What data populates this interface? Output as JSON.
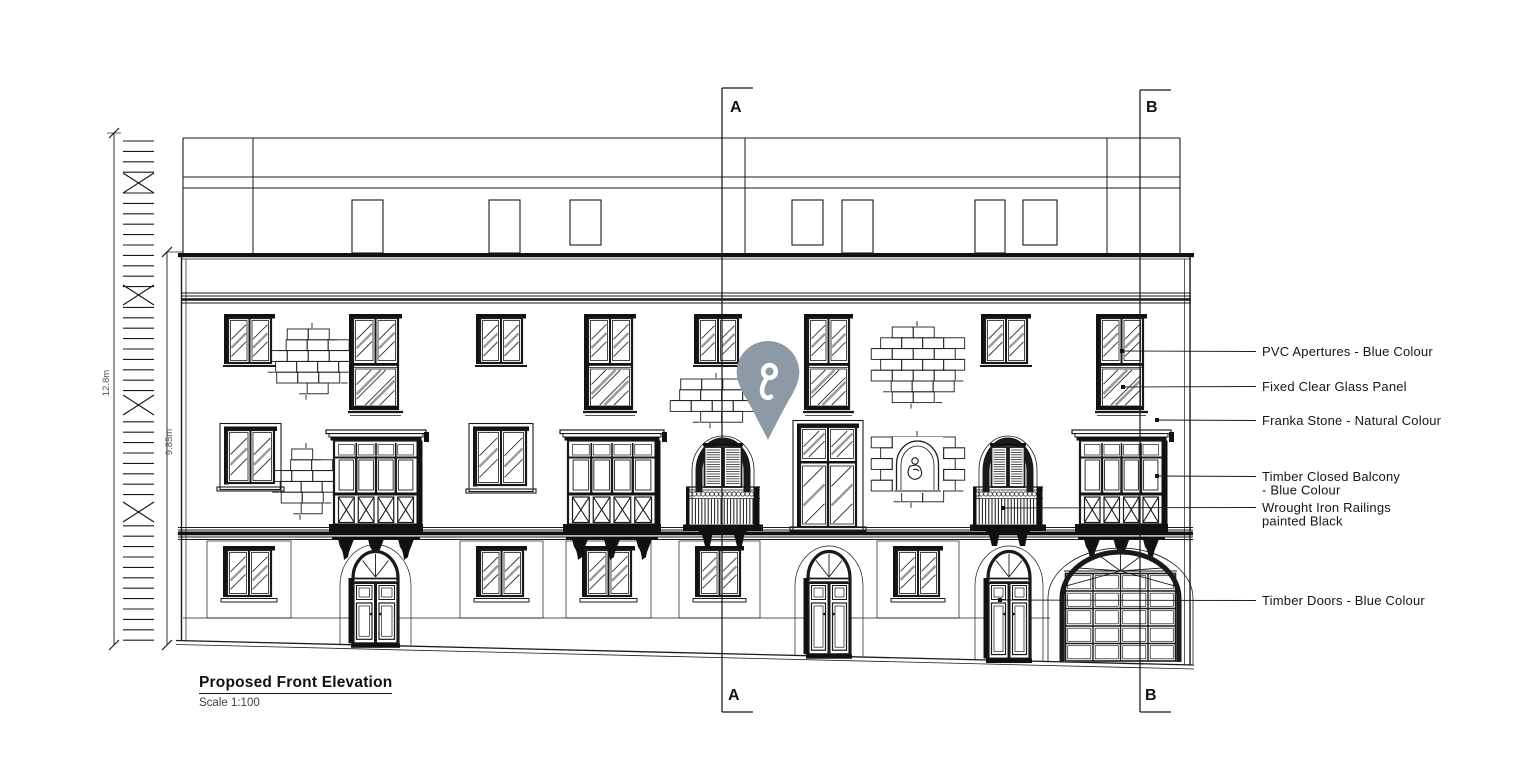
{
  "colors": {
    "ink": "#1a1a1a",
    "paper": "#ffffff",
    "hatch": "#303030",
    "reflection": "#9a9a9a",
    "pin": "#8c99a7"
  },
  "title_block": {
    "title": "Proposed Front Elevation",
    "scale": "Scale 1:100"
  },
  "dimensions": [
    {
      "label": "12.8m",
      "x": 114,
      "y1": 133,
      "y2": 645,
      "label_x": 109,
      "label_y": 383
    },
    {
      "label": "9.85m",
      "x": 167,
      "y1": 252,
      "y2": 645,
      "label_x": 172,
      "label_y": 442
    }
  ],
  "ruler": {
    "x1": 123,
    "x2": 154,
    "y_top": 141,
    "y_bottom": 641,
    "step": 10.4,
    "cross_marks_y": [
      183,
      295,
      405,
      512
    ]
  },
  "section_markers": [
    {
      "label": "A",
      "x": 722,
      "top": 88,
      "bottom": 712,
      "arm": 31,
      "tx_top": 730,
      "ty_top": 112,
      "tx_bot": 728,
      "ty_bot": 700
    },
    {
      "label": "B",
      "x": 1140,
      "top": 90,
      "bottom": 712,
      "arm": 31,
      "tx_top": 1146,
      "ty_top": 112,
      "tx_bot": 1145,
      "ty_bot": 700
    }
  ],
  "annotations": [
    {
      "id": "pvc-apertures",
      "lines": [
        "PVC Apertures - Blue Colour"
      ],
      "text_x": 1262,
      "text_y": 356,
      "anchor_x": 1122,
      "anchor_y": 351
    },
    {
      "id": "glass-panel",
      "lines": [
        "Fixed Clear Glass Panel"
      ],
      "text_x": 1262,
      "text_y": 391,
      "anchor_x": 1123,
      "anchor_y": 387
    },
    {
      "id": "franka-stone",
      "lines": [
        "Franka Stone - Natural Colour"
      ],
      "text_x": 1262,
      "text_y": 425,
      "anchor_x": 1157,
      "anchor_y": 420
    },
    {
      "id": "timber-balcony",
      "lines": [
        "Timber Closed Balcony",
        "- Blue Colour"
      ],
      "text_x": 1262,
      "text_y": 481,
      "anchor_x": 1157,
      "anchor_y": 476
    },
    {
      "id": "iron-railings",
      "lines": [
        "Wrought Iron Railings",
        "painted Black"
      ],
      "text_x": 1262,
      "text_y": 512,
      "anchor_x": 1003,
      "anchor_y": 508
    },
    {
      "id": "timber-doors",
      "lines": [
        "Timber Doors - Blue Colour"
      ],
      "text_x": 1262,
      "text_y": 605,
      "anchor_x": 1000,
      "anchor_y": 600
    }
  ],
  "pin": {
    "cx": 768,
    "top": 341,
    "color": "#8c99a7"
  },
  "building": {
    "roof": {
      "left": 183,
      "right": 1180,
      "top": 138,
      "bottom": 253,
      "band1": 177,
      "band2": 188,
      "dividers": [
        253,
        745,
        1107
      ],
      "doors": [
        [
          352,
          31
        ],
        [
          489,
          31
        ],
        [
          842,
          31
        ],
        [
          975,
          30
        ]
      ],
      "windows": [
        [
          570,
          31
        ],
        [
          792,
          31
        ],
        [
          1023,
          34
        ]
      ]
    },
    "facade": {
      "left": 181.5,
      "left2": 186,
      "right": 1190,
      "right2": 1184.5,
      "cornice_mid": [
        293,
        296,
        299.5,
        303
      ],
      "cornice_low_thin": [
        527.5,
        530,
        537,
        539.5
      ],
      "cornice_low_thick": 531.5,
      "panel_line_y": 618
    },
    "base": {
      "x1": 176,
      "y1": 640.5,
      "x2": 1194,
      "y2": 665,
      "gap": 4
    },
    "windows_top_small": [
      [
        228,
        43
      ],
      [
        480,
        42
      ],
      [
        698,
        40
      ],
      [
        985,
        42
      ]
    ],
    "windows_top_tall": [
      [
        353,
        45
      ],
      [
        588,
        44
      ],
      [
        808,
        41
      ],
      [
        1100,
        43
      ]
    ],
    "windows_mid": [
      [
        227,
        47,
        53
      ],
      [
        476,
        50,
        55
      ]
    ],
    "window_mid_tall": [
      800,
      56,
      100
    ],
    "windows_ground": [
      [
        227,
        44
      ],
      [
        480,
        43
      ],
      [
        586,
        45
      ],
      [
        699,
        41
      ],
      [
        897,
        42
      ]
    ],
    "closed_balconies": [
      [
        331,
        90
      ],
      [
        565,
        94
      ],
      [
        1077,
        89
      ]
    ],
    "open_balconies": [
      [
        691,
        64
      ],
      [
        978,
        60
      ]
    ],
    "doors": [
      [
        353,
        45
      ],
      [
        808,
        42
      ],
      [
        988,
        42
      ]
    ],
    "garage": {
      "x": 1058,
      "w": 125
    },
    "brick_patches": [
      {
        "cx": 312,
        "top": 329,
        "rows": [
          2,
          3,
          4,
          4,
          3,
          1
        ]
      },
      {
        "cx": 306,
        "top": 449,
        "rows": [
          1,
          2,
          3,
          3,
          2,
          1
        ]
      },
      {
        "cx": 716,
        "top": 379,
        "rows": [
          3,
          4,
          4,
          2
        ]
      },
      {
        "cx": 917,
        "top": 327,
        "rows": [
          2,
          4,
          4,
          4,
          4,
          3,
          2
        ]
      },
      {
        "cx": 917,
        "top": 437,
        "rows": [
          4,
          4,
          4,
          4,
          4,
          2
        ]
      }
    ],
    "niche": {
      "x": 897,
      "apex_y": 441,
      "w": 41,
      "bottom": 490
    }
  }
}
